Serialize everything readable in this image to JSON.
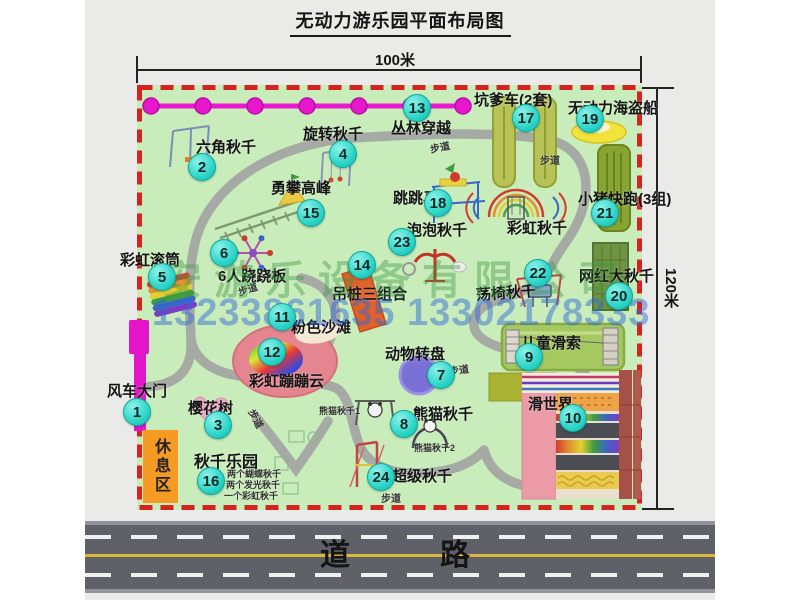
{
  "title": "无动力游乐园平面布局图",
  "dimensions": {
    "top": "100米",
    "right": "120米"
  },
  "road": {
    "label": "道　　路"
  },
  "watermarks": {
    "company": "安游乐设备有限公司",
    "phone": "13233861635 13302178333"
  },
  "rest_area_label": "休息区",
  "map": {
    "badges": [
      {
        "n": "1",
        "x": 136,
        "y": 411
      },
      {
        "n": "2",
        "x": 201,
        "y": 166
      },
      {
        "n": "3",
        "x": 217,
        "y": 424
      },
      {
        "n": "4",
        "x": 342,
        "y": 153
      },
      {
        "n": "5",
        "x": 161,
        "y": 276
      },
      {
        "n": "6",
        "x": 223,
        "y": 252
      },
      {
        "n": "7",
        "x": 440,
        "y": 374
      },
      {
        "n": "8",
        "x": 403,
        "y": 423
      },
      {
        "n": "9",
        "x": 528,
        "y": 356
      },
      {
        "n": "10",
        "x": 572,
        "y": 417
      },
      {
        "n": "11",
        "x": 281,
        "y": 316
      },
      {
        "n": "12",
        "x": 271,
        "y": 351
      },
      {
        "n": "13",
        "x": 416,
        "y": 107
      },
      {
        "n": "14",
        "x": 361,
        "y": 264
      },
      {
        "n": "15",
        "x": 310,
        "y": 212
      },
      {
        "n": "16",
        "x": 210,
        "y": 480
      },
      {
        "n": "17",
        "x": 525,
        "y": 117
      },
      {
        "n": "18",
        "x": 437,
        "y": 202
      },
      {
        "n": "19",
        "x": 589,
        "y": 118
      },
      {
        "n": "20",
        "x": 618,
        "y": 295
      },
      {
        "n": "21",
        "x": 604,
        "y": 212
      },
      {
        "n": "22",
        "x": 537,
        "y": 272
      },
      {
        "n": "23",
        "x": 401,
        "y": 241
      },
      {
        "n": "24",
        "x": 380,
        "y": 476
      }
    ],
    "labels": [
      {
        "t": "风车大门",
        "x": 107,
        "y": 380
      },
      {
        "t": "六角秋千",
        "x": 196,
        "y": 136
      },
      {
        "t": "樱花树",
        "x": 188,
        "y": 397
      },
      {
        "t": "旋转秋千",
        "x": 303,
        "y": 123
      },
      {
        "t": "彩虹滚筒",
        "x": 120,
        "y": 249
      },
      {
        "t": "6人跷跷板",
        "x": 218,
        "y": 265
      },
      {
        "t": "动物转盘",
        "x": 385,
        "y": 343
      },
      {
        "t": "熊猫秋千",
        "x": 413,
        "y": 403
      },
      {
        "t": "儿童滑索",
        "x": 521,
        "y": 332
      },
      {
        "t": "滑世界",
        "x": 528,
        "y": 393
      },
      {
        "t": "粉色沙滩",
        "x": 291,
        "y": 316
      },
      {
        "t": "彩虹蹦蹦云",
        "x": 249,
        "y": 370
      },
      {
        "t": "丛林穿越",
        "x": 391,
        "y": 117
      },
      {
        "t": "吊桩三组合",
        "x": 332,
        "y": 283
      },
      {
        "t": "勇攀高峰",
        "x": 271,
        "y": 177
      },
      {
        "t": "秋千乐园",
        "x": 194,
        "y": 448,
        "s": 16
      },
      {
        "t": "坑爹车(2套)",
        "x": 474,
        "y": 89
      },
      {
        "t": "跳跳马",
        "x": 393,
        "y": 187
      },
      {
        "t": "无动力海盗船",
        "x": 568,
        "y": 97
      },
      {
        "t": "网红大秋千",
        "x": 579,
        "y": 265
      },
      {
        "t": "小猪快跑(3组)",
        "x": 578,
        "y": 188
      },
      {
        "t": "荡椅秋千",
        "x": 476,
        "y": 284,
        "r": -4
      },
      {
        "t": "泡泡秋千",
        "x": 407,
        "y": 219
      },
      {
        "t": "超级秋千",
        "x": 392,
        "y": 465
      },
      {
        "t": "彩虹秋千",
        "x": 507,
        "y": 217
      },
      {
        "t": "熊猫秋千1",
        "x": 319,
        "y": 404,
        "s": 9
      },
      {
        "t": "熊猫秋千2",
        "x": 414,
        "y": 441,
        "s": 9
      },
      {
        "t": "两个蝴蝶秋千",
        "x": 227,
        "y": 467,
        "s": 9
      },
      {
        "t": "两个发光秋千",
        "x": 226,
        "y": 478,
        "s": 9
      },
      {
        "t": "一个彩虹秋千",
        "x": 224,
        "y": 489,
        "s": 9
      },
      {
        "t": "步道",
        "x": 238,
        "y": 284,
        "s": 10,
        "r": -18
      },
      {
        "t": "步道",
        "x": 430,
        "y": 141,
        "s": 10,
        "r": -12
      },
      {
        "t": "步道",
        "x": 540,
        "y": 152,
        "s": 10
      },
      {
        "t": "步道",
        "x": 252,
        "y": 402,
        "s": 10,
        "r": 62
      },
      {
        "t": "步道",
        "x": 381,
        "y": 490,
        "s": 10
      },
      {
        "t": "步道",
        "x": 449,
        "y": 363,
        "s": 10,
        "r": -8
      }
    ]
  },
  "colors": {
    "map_bg": "#c9ecbb",
    "border_red": "#d42420",
    "zipline_magenta": "#e617cd",
    "badge_cyan": "#2bd4c7",
    "rest_orange": "#f59a23",
    "road_gray": "#606069"
  }
}
